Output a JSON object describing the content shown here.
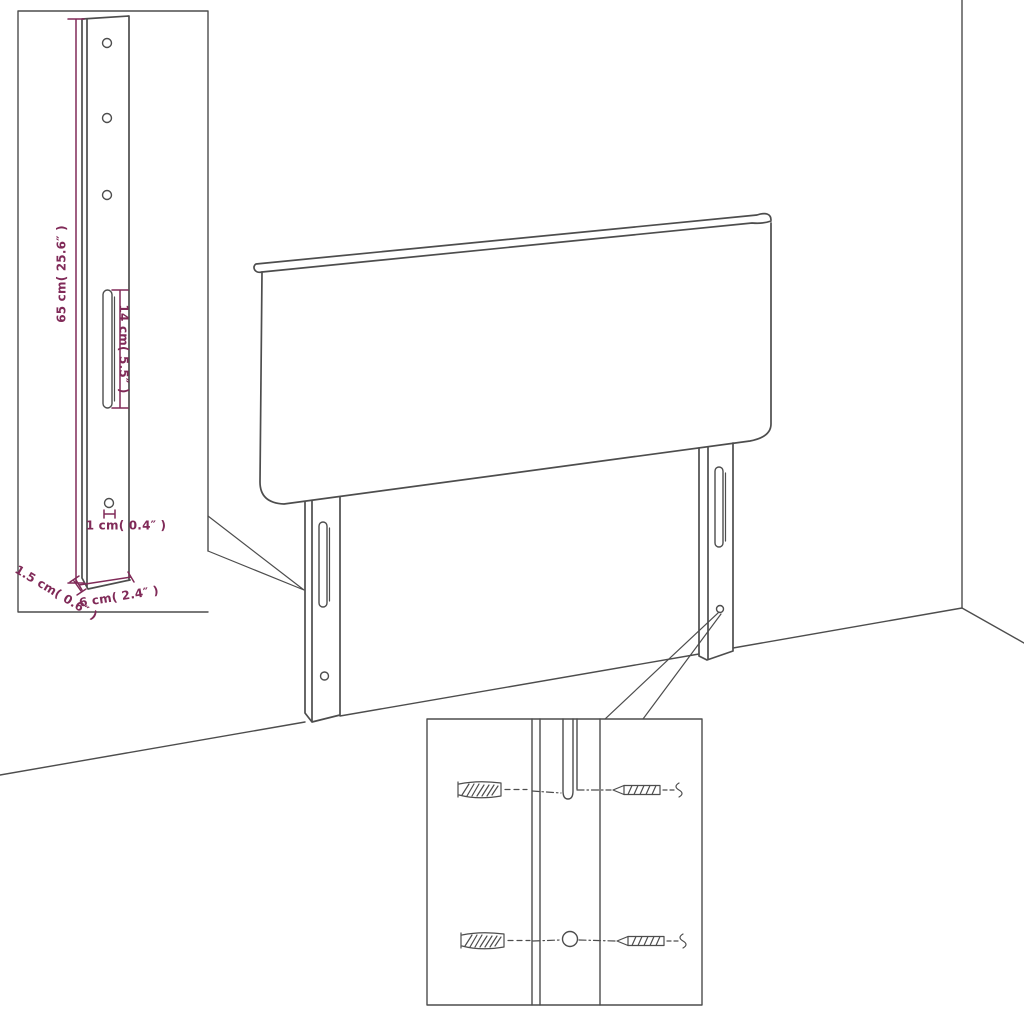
{
  "scene": {
    "subject": "headboard-with-mounting-legs-assembly-diagram"
  },
  "colors": {
    "line": "#4d4d4d",
    "dimension": "#802a58",
    "background": "#ffffff"
  },
  "leg_detail": {
    "dimensions": {
      "height": "65 cm( 25.6″ )",
      "slot_length": "14 cm( 5.5″ )",
      "hole_diameter": "1 cm( 0.4″ )",
      "thickness": "1.5 cm( 0.6″ )",
      "width": "6 cm( 2.4″ )"
    },
    "features": [
      "screw-hole-icon",
      "adjustment-slot-icon"
    ]
  },
  "hardware_detail": {
    "parts": [
      "wall-plug-icon",
      "screw-icon",
      "leg-slot-icon",
      "leg-hole-icon"
    ]
  }
}
